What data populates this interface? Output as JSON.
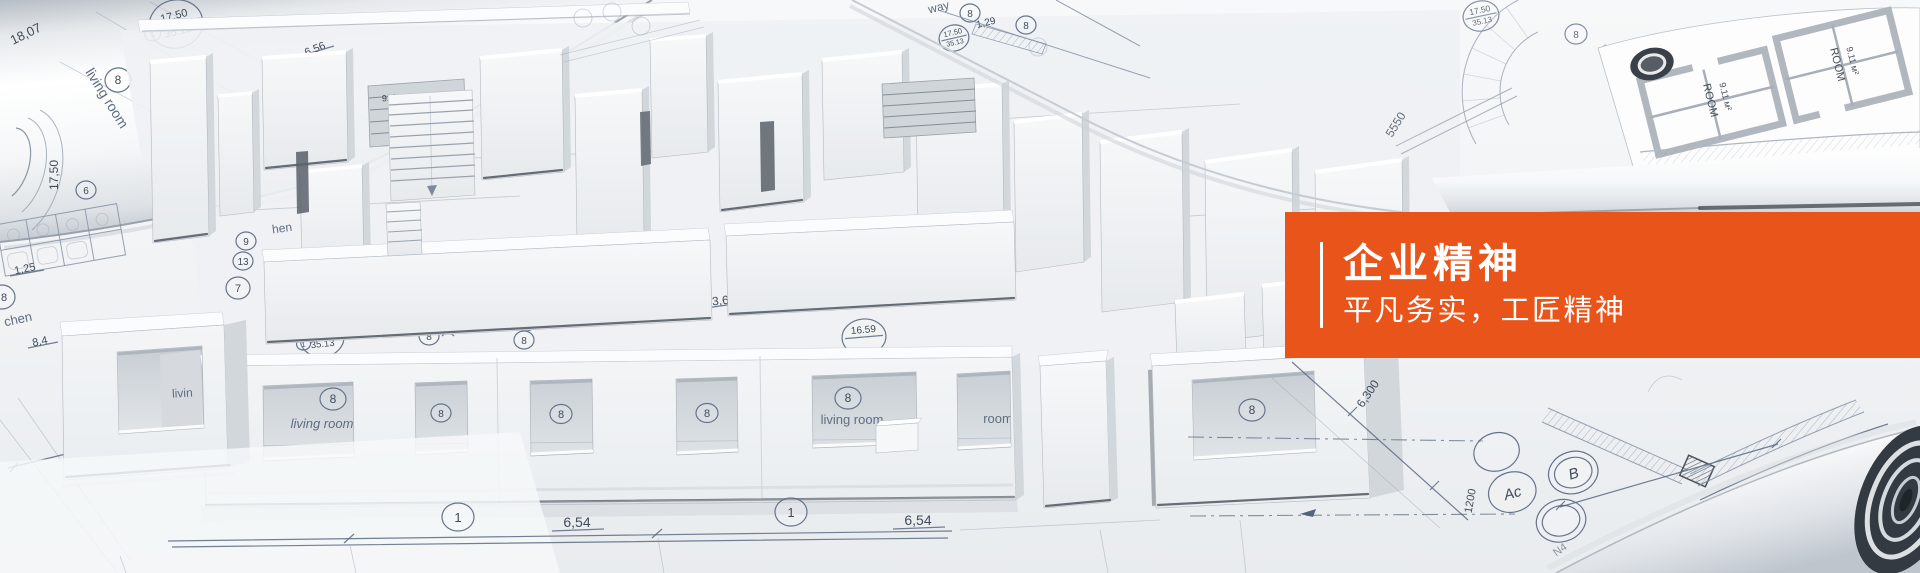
{
  "banner": {
    "title": "企业精神",
    "subtitle": "平凡务实，工匠精神",
    "panel_color": "#e8541a",
    "text_color": "#ffffff"
  },
  "labels": {
    "living_room": "living room",
    "living_partial": "livin",
    "room_partial": "room",
    "kitchen_partial": "chen",
    "kitchen_partial2": "hen",
    "hallway_partial": "way",
    "c1": "1",
    "c6": "6",
    "c7": "7",
    "c8": "8",
    "c9": "9",
    "c13": "13",
    "c16": "16",
    "ac": "Ac",
    "b": "B",
    "d654": "6,54",
    "d360": "3,60",
    "d125": "1,25",
    "d84": "8,4",
    "d129": "1,29",
    "d656": "6,56",
    "d1750": "17,50",
    "d1807": "18,07",
    "d5550": "5550",
    "d6300": "6,300",
    "d1200": "1200",
    "n4": "N4",
    "a1750": "17.50",
    "a3513": "35.13",
    "a1659": "16.59",
    "d920": "920",
    "visor": "Visor№1",
    "room_stamp": "ROOM",
    "room_area": "9.11 м²"
  }
}
